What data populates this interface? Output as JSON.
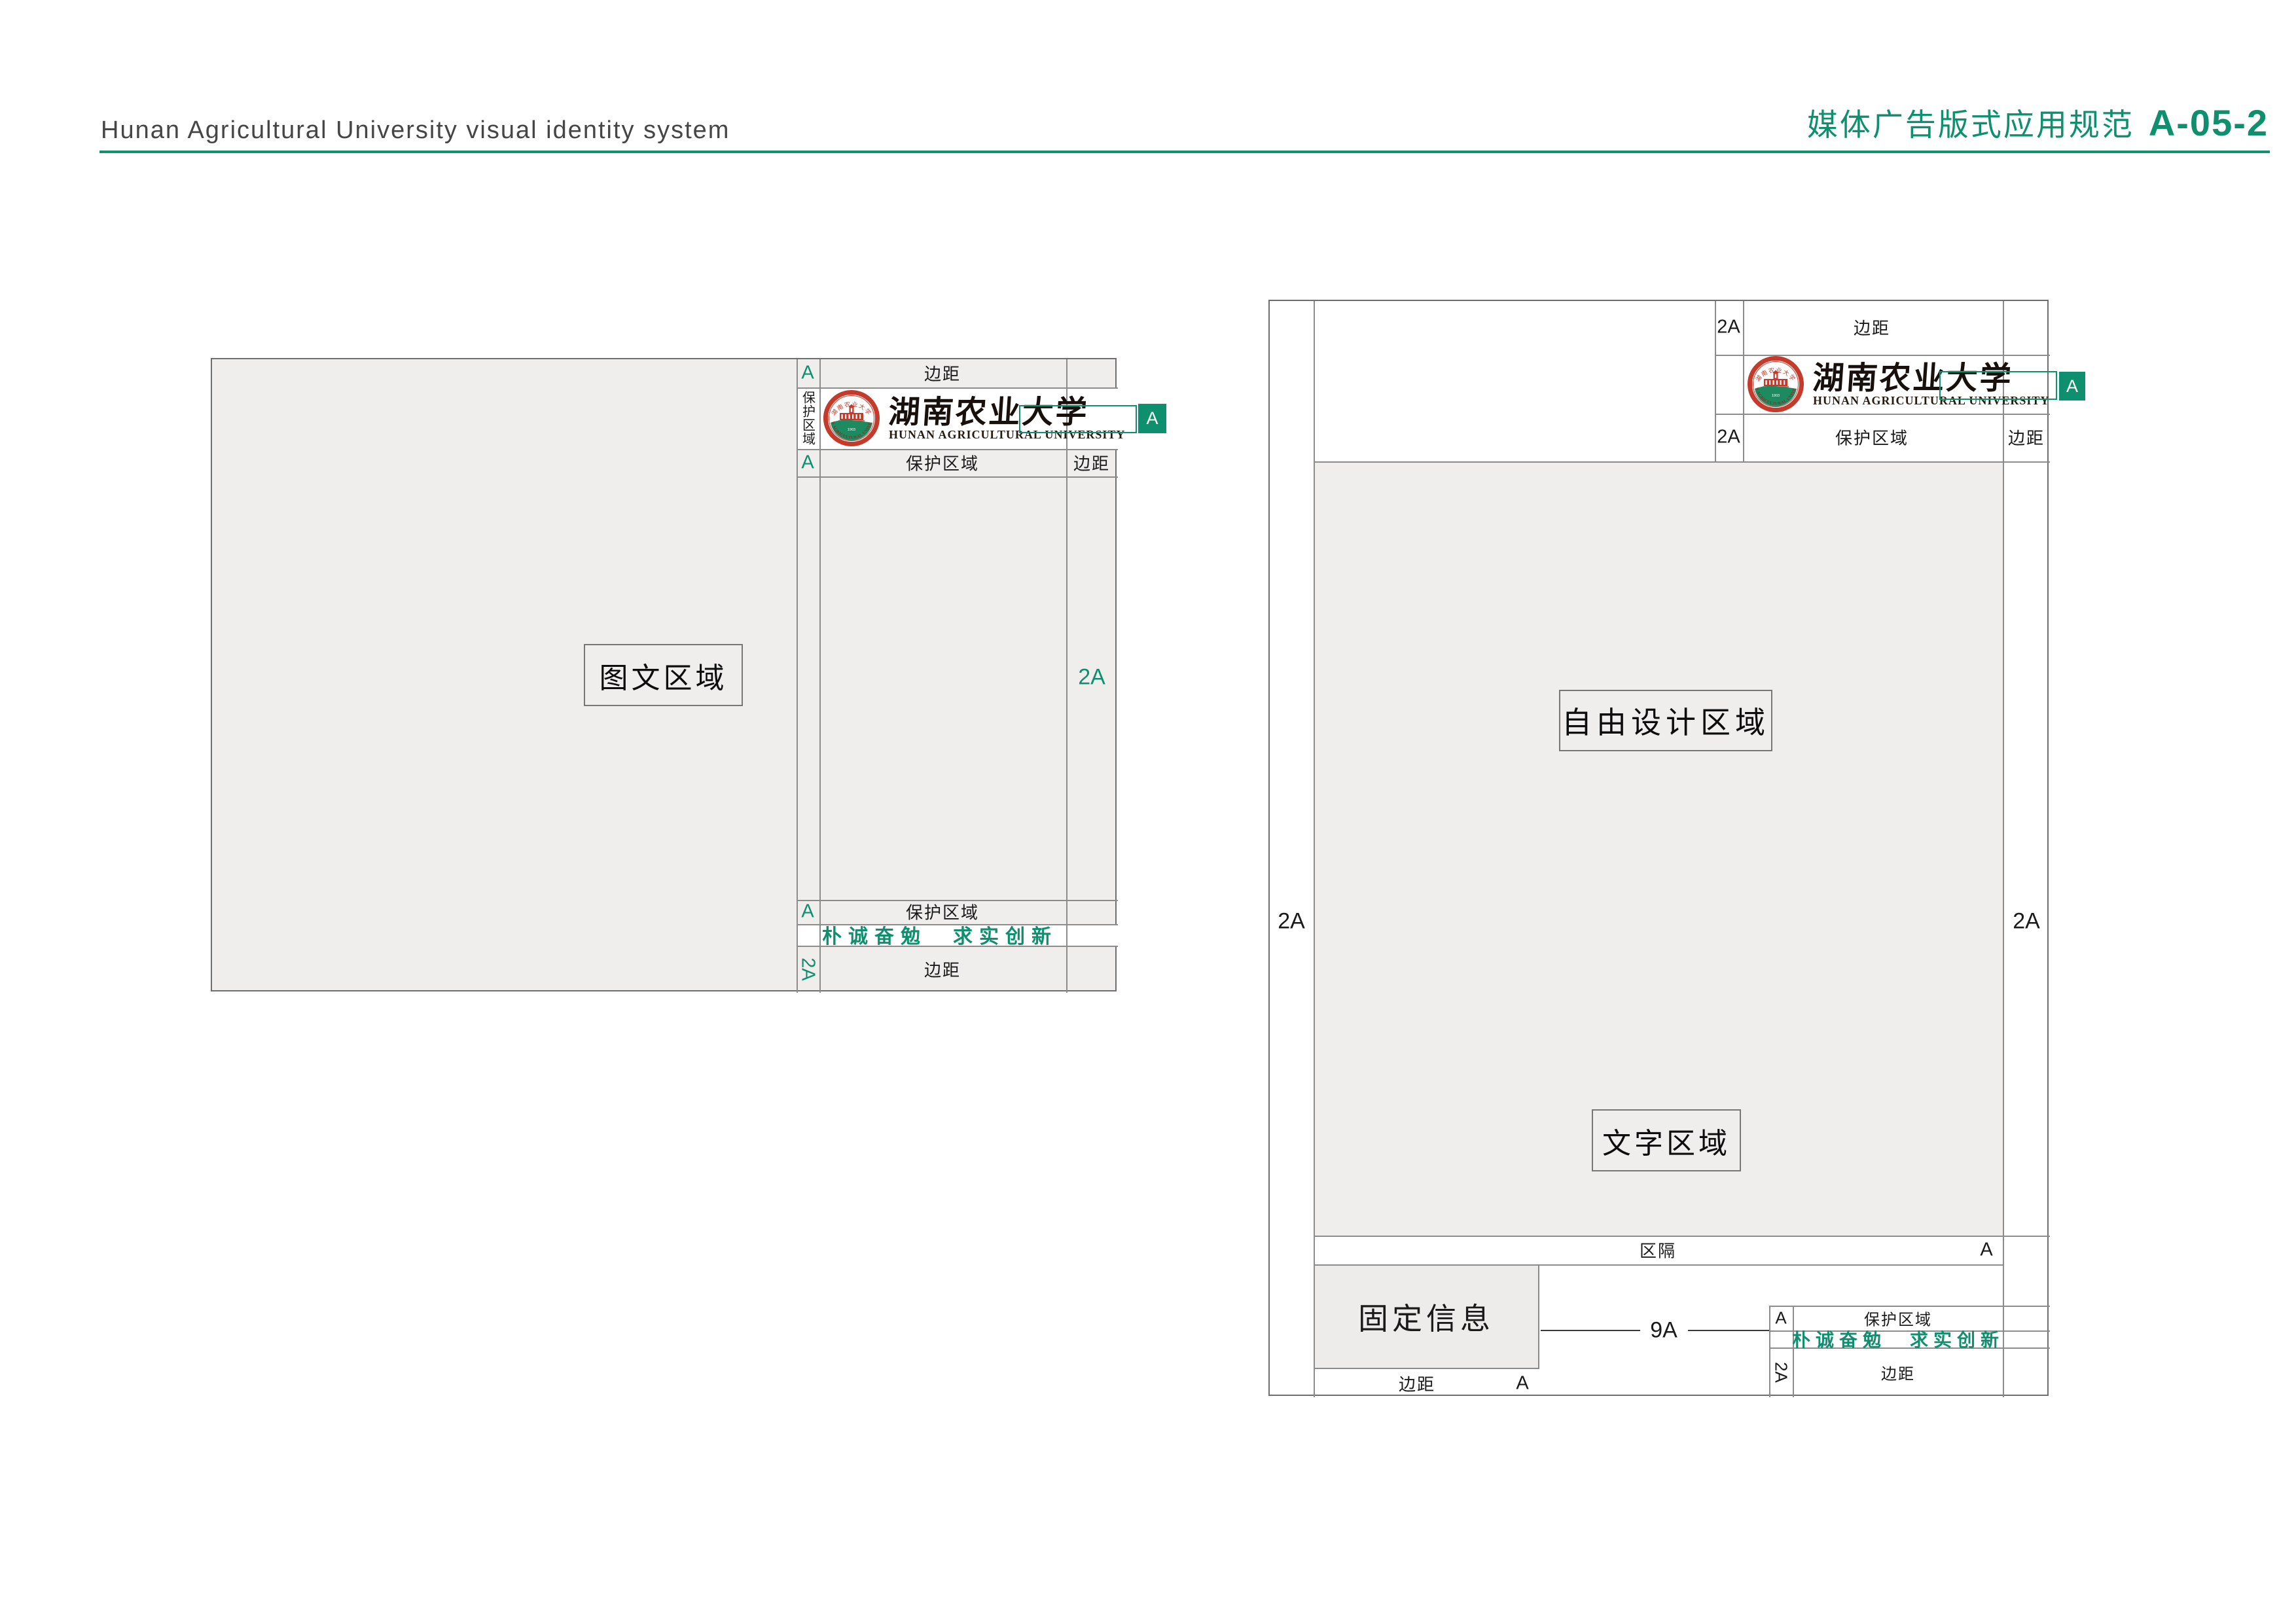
{
  "header": {
    "title_en": "Hunan Agricultural University visual identity system",
    "doc_category": "媒体广告版式应用规范",
    "doc_code": "A-05-2"
  },
  "labels": {
    "margin": "边距",
    "protected_area": "保护区域",
    "divider": "区隔",
    "a": "A",
    "two_a": "2A",
    "nine_a": "9A"
  },
  "areas": {
    "image_text_area": "图文区域",
    "free_design_area": "自由设计区域",
    "text_area": "文字区域",
    "fixed_info_area": "固定信息"
  },
  "slogan": "朴诚奋勉　求实创新",
  "logo": {
    "seal_top_text": "湖南农业大学",
    "seal_arc_text": "HUNAN AGRICULTURAL UNIVERSITY",
    "seal_year": "1903",
    "wordmark_zh": "湖南农业大学",
    "wordmark_en": "HUNAN AGRICULTURAL UNIVERSITY"
  },
  "colors": {
    "accent_green": "#0E8F6E",
    "logo_red": "#C43A2B",
    "logo_ground_green": "#1E8A60",
    "panel_gray": "#EFEEED",
    "line_gray": "#8C8C8C",
    "header_text_gray": "#464646"
  }
}
